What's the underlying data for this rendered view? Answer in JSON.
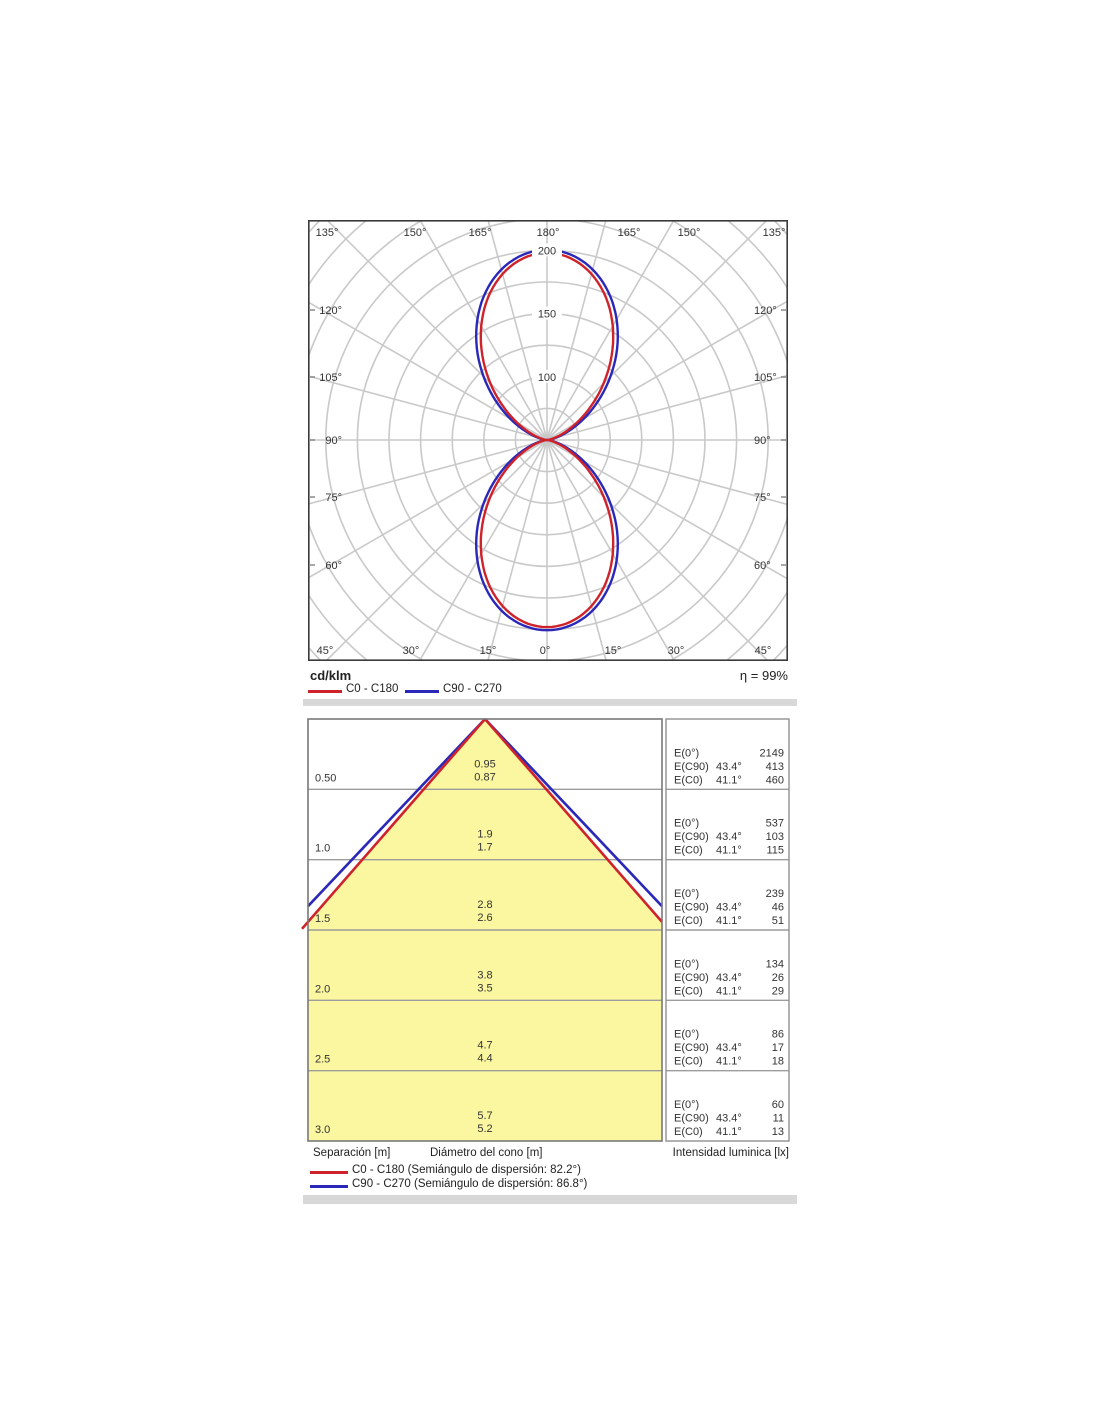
{
  "colors": {
    "accent_red": "#cf232b",
    "accent_blue": "#2a28b8",
    "cone_fill": "#faf7a0",
    "separator_bar": "#d8d8d8",
    "grid_gray": "#c9c9c9"
  },
  "polar_chart": {
    "unit_label": "cd/klm",
    "efficiency_label": "η = 99%",
    "legend": [
      {
        "label": "C0 - C180",
        "color": "#cf232b"
      },
      {
        "label": "C90 - C270",
        "color": "#2a28b8"
      }
    ],
    "angle_labels_top": [
      "135°",
      "150°",
      "165°",
      "180°",
      "165°",
      "150°",
      "135°"
    ],
    "angle_labels_bottom": [
      "45°",
      "30°",
      "15°",
      "0°",
      "15°",
      "30°",
      "45°"
    ],
    "angle_labels_left": [
      "120°",
      "105°",
      "90°",
      "75°",
      "60°"
    ],
    "angle_labels_right": [
      "120°",
      "105°",
      "90°",
      "75°",
      "60°"
    ],
    "radial_tick_labels": [
      "100",
      "150",
      "200",
      "250"
    ]
  },
  "cone_chart": {
    "e_row_labels": [
      "E(0°)",
      "E(C90)",
      "E(C0)"
    ],
    "rows": [
      {
        "separation": "0.50",
        "d_c90": "0.95",
        "d_c0": "0.87",
        "e0": "2149",
        "a90": "43.4°",
        "e90": "413",
        "a0": "41.1°",
        "ec0": "460"
      },
      {
        "separation": "1.0",
        "d_c90": "1.9",
        "d_c0": "1.7",
        "e0": "537",
        "a90": "43.4°",
        "e90": "103",
        "a0": "41.1°",
        "ec0": "115"
      },
      {
        "separation": "1.5",
        "d_c90": "2.8",
        "d_c0": "2.6",
        "e0": "239",
        "a90": "43.4°",
        "e90": "46",
        "a0": "41.1°",
        "ec0": "51"
      },
      {
        "separation": "2.0",
        "d_c90": "3.8",
        "d_c0": "3.5",
        "e0": "134",
        "a90": "43.4°",
        "e90": "26",
        "a0": "41.1°",
        "ec0": "29"
      },
      {
        "separation": "2.5",
        "d_c90": "4.7",
        "d_c0": "4.4",
        "e0": "86",
        "a90": "43.4°",
        "e90": "17",
        "a0": "41.1°",
        "ec0": "18"
      },
      {
        "separation": "3.0",
        "d_c90": "5.7",
        "d_c0": "5.2",
        "e0": "60",
        "a90": "43.4°",
        "e90": "11",
        "a0": "41.1°",
        "ec0": "13"
      }
    ],
    "footer": {
      "separation": "Separación [m]",
      "diameter": "Diámetro del cono [m]",
      "intensity": "Intensidad luminica [lx]"
    },
    "legend": [
      {
        "label": "C0 - C180 (Semiángulo de dispersión: 82.2°)",
        "color": "#cf232b"
      },
      {
        "label": "C90 - C270 (Semiángulo de dispersión: 86.8°)",
        "color": "#2a28b8"
      }
    ]
  },
  "chart_data": [
    {
      "type": "polar-intensity",
      "title": "Luminous intensity distribution curve",
      "unit": "cd/klm",
      "efficiency_percent": 99,
      "ring_step": 50,
      "radial_ticks": [
        100,
        150,
        200,
        250
      ],
      "angle_step_deg": 15,
      "angle_range": "0-180 both sides, 0° at bottom, 180° at top",
      "series": [
        {
          "name": "C0 - C180",
          "color": "#cf232b",
          "peak": 296,
          "half_beam_angle_deg": 41.1
        },
        {
          "name": "C90 - C270",
          "color": "#2a28b8",
          "peak": 301,
          "half_beam_angle_deg": 43.4
        }
      ]
    },
    {
      "type": "cone-diagram",
      "title": "Cone diagram",
      "separations_m": [
        0.5,
        1.0,
        1.5,
        2.0,
        2.5,
        3.0
      ],
      "cone_diameter_m": {
        "C90_C270": [
          0.95,
          1.9,
          2.8,
          3.8,
          4.7,
          5.7
        ],
        "C0_C180": [
          0.87,
          1.7,
          2.6,
          3.5,
          4.4,
          5.2
        ]
      },
      "illuminance_lx": {
        "E0": [
          2149,
          537,
          239,
          134,
          86,
          60
        ],
        "EC90": [
          413,
          103,
          46,
          26,
          17,
          11
        ],
        "EC0": [
          460,
          115,
          51,
          29,
          18,
          13
        ]
      },
      "beam_half_angles_deg": {
        "C90": 43.4,
        "C0": 41.1
      },
      "dispersion_semiangle_deg": {
        "C0_C180": 82.2,
        "C90_C270": 86.8
      }
    }
  ]
}
